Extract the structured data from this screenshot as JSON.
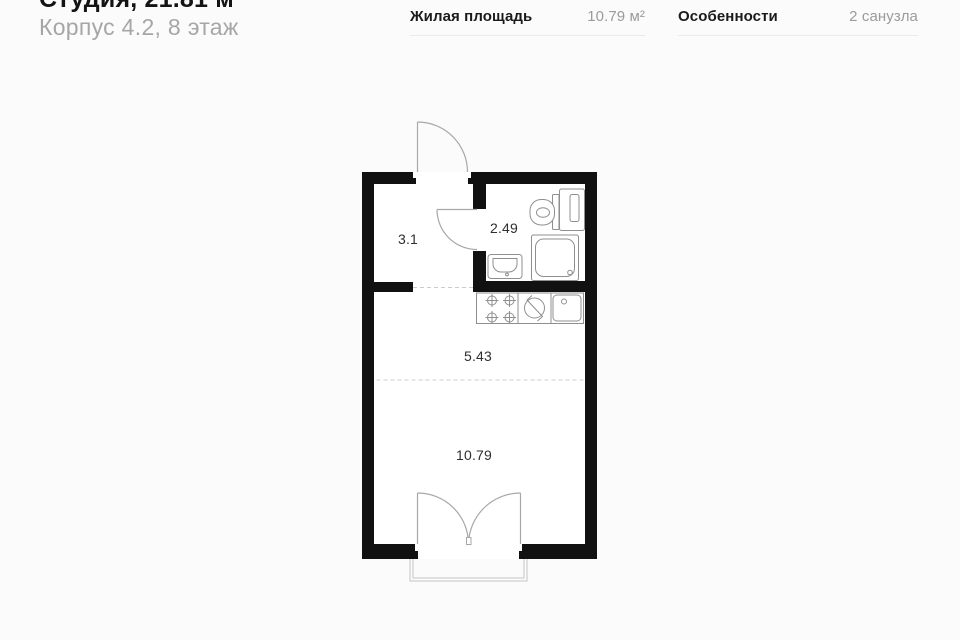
{
  "header": {
    "title": "Студия, 21.81 м²",
    "subtitle": "Корпус 4.2, 8 этаж"
  },
  "stats": [
    {
      "label": "Жилая площадь",
      "value": "10.79 м²"
    },
    {
      "label": "Особенности",
      "value": "2 санузла"
    }
  ],
  "floorplan": {
    "room_labels": {
      "hallway": "3.1",
      "bathroom": "2.49",
      "kitchen_zone": "5.43",
      "living_zone": "10.79"
    },
    "fixtures": [
      "entry-door",
      "bathroom-door",
      "toilet",
      "towel-dryer",
      "shower",
      "bath-sink",
      "stove",
      "kitchen-sink",
      "balcony-doors",
      "balcony"
    ],
    "colors": {
      "wall": "#111111",
      "fixture_line": "#8f8f8f",
      "door_line": "#a8a8a8",
      "dashed_line": "#cccccc",
      "balcony_line": "#c6c6c6"
    }
  },
  "colors": {
    "page_bg": "#fbfbfb",
    "title": "#141414",
    "subtitle": "#a6a6a6",
    "stat_label": "#1a1a1a",
    "stat_value": "#9b9b9b",
    "divider": "#eaeaea"
  }
}
